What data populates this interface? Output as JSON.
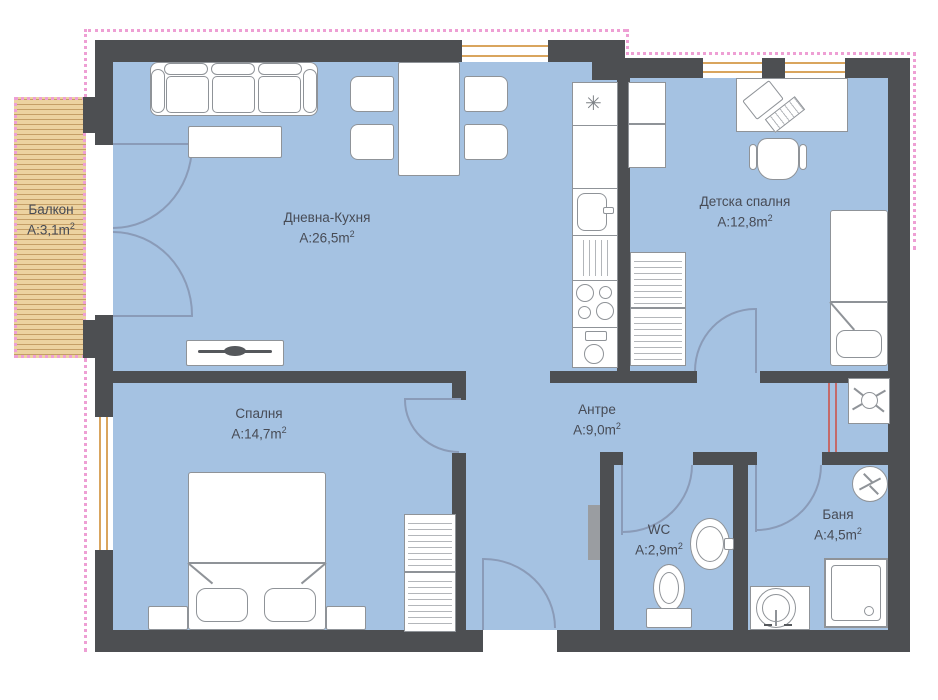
{
  "plan_title": "apartment-floor-plan",
  "colors": {
    "room_fill": "#a5c2e2",
    "wall": "#4d4f52",
    "balcony_wood": "#ecd2a0",
    "railing_pink": "#ee9fd4",
    "window_frame": "#d9a55e",
    "door_arc": "#8a9bb8",
    "fixture_border": "#8f9398",
    "label_text": "#474b55",
    "plumbing_red": "#c46a6a"
  },
  "rooms": {
    "balcony": {
      "name": "Балкон",
      "area": "A:3,1m",
      "sup": "2"
    },
    "living_kitchen": {
      "name": "Дневна-Кухня",
      "area": "A:26,5m",
      "sup": "2"
    },
    "children_bedroom": {
      "name": "Детска спалня",
      "area": "A:12,8m",
      "sup": "2"
    },
    "bedroom": {
      "name": "Спалня",
      "area": "A:14,7m",
      "sup": "2"
    },
    "hallway": {
      "name": "Антре",
      "area": "A:9,0m",
      "sup": "2"
    },
    "wc": {
      "name": "WC",
      "area": "A:2,9m",
      "sup": "2"
    },
    "bathroom": {
      "name": "Баня",
      "area": "A:4,5m",
      "sup": "2"
    }
  },
  "icons": {
    "kitchen_vent_glyph": "✳"
  }
}
